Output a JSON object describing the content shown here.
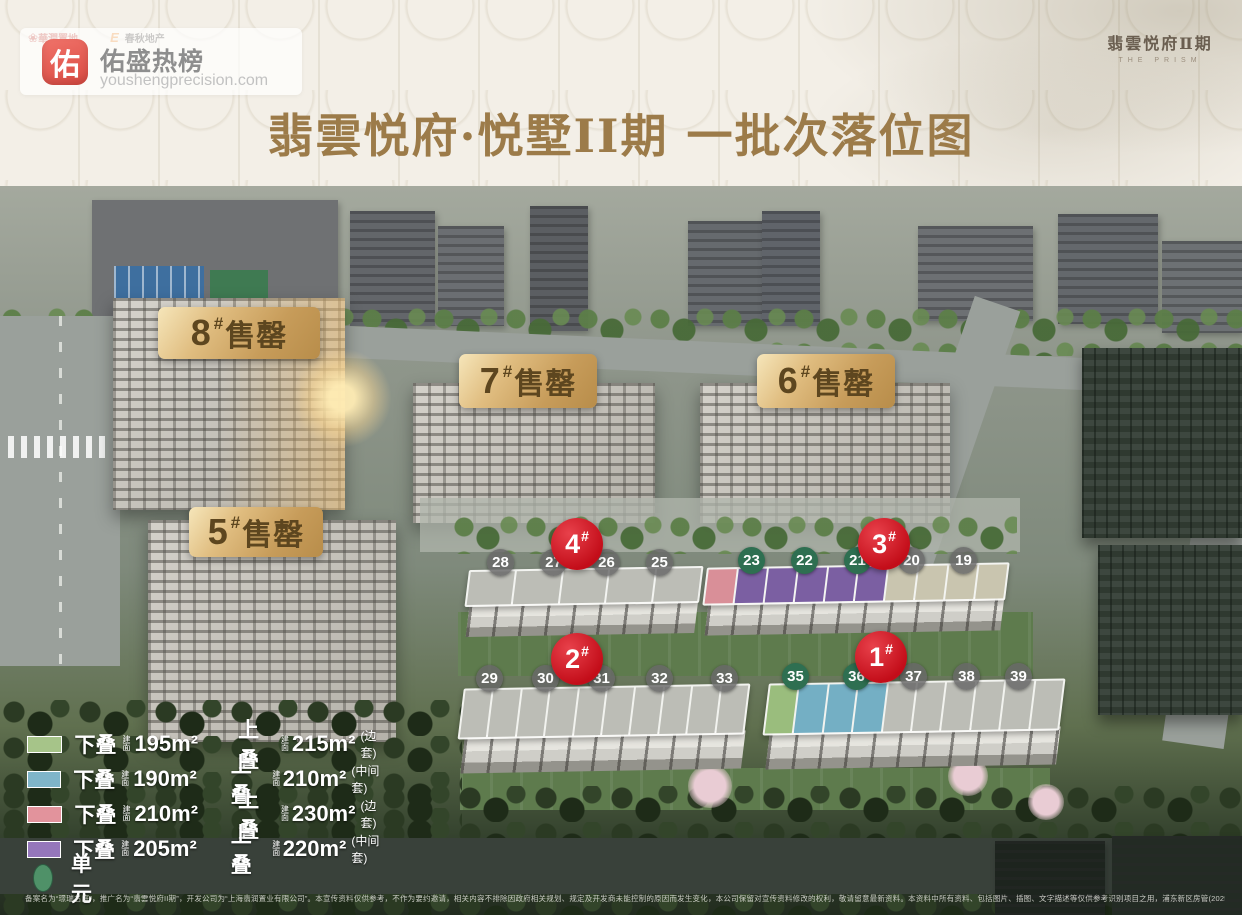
{
  "watermark": {
    "icon": "佑",
    "title": "佑盛热榜",
    "url": "youshengprecision.com"
  },
  "partners": {
    "logo_red_mark": "❀",
    "logo_red": "華潤置地",
    "logo_orange_mark": "E",
    "logo_calligraphy": "春秋地产"
  },
  "brand": {
    "name": "翡雲悦府Ⅱ期",
    "tagline": "THE PRISM"
  },
  "page_title": "翡雲悦府·悦墅II期  一批次落位图",
  "sold_out": [
    {
      "num": "8",
      "hash": "#",
      "status": "售罄"
    },
    {
      "num": "7",
      "hash": "#",
      "status": "售罄"
    },
    {
      "num": "6",
      "hash": "#",
      "status": "售罄"
    },
    {
      "num": "5",
      "hash": "#",
      "status": "售罄"
    }
  ],
  "badges": [
    {
      "num": "4",
      "hash": "#"
    },
    {
      "num": "3",
      "hash": "#"
    },
    {
      "num": "2",
      "hash": "#"
    },
    {
      "num": "1",
      "hash": "#"
    }
  ],
  "units": {
    "north": [
      {
        "num": "28",
        "chip": "chip_gray"
      },
      {
        "num": "27",
        "chip": "chip_gray"
      },
      {
        "num": "26",
        "chip": "chip_gray"
      },
      {
        "num": "25",
        "chip": "chip_gray"
      },
      {
        "num": "23",
        "chip": "chip_green"
      },
      {
        "num": "22",
        "chip": "chip_green"
      },
      {
        "num": "21",
        "chip": "chip_green"
      },
      {
        "num": "20",
        "chip": "chip_gray"
      },
      {
        "num": "19",
        "chip": "chip_gray"
      }
    ],
    "south": [
      {
        "num": "29",
        "chip": "chip_gray"
      },
      {
        "num": "30",
        "chip": "chip_gray"
      },
      {
        "num": "31",
        "chip": "chip_gray"
      },
      {
        "num": "32",
        "chip": "chip_gray"
      },
      {
        "num": "33",
        "chip": "chip_gray"
      },
      {
        "num": "35",
        "chip": "chip_green"
      },
      {
        "num": "36",
        "chip": "chip_green"
      },
      {
        "num": "37",
        "chip": "chip_gray"
      },
      {
        "num": "38",
        "chip": "chip_gray"
      },
      {
        "num": "39",
        "chip": "chip_gray"
      }
    ]
  },
  "roofs": {
    "north_left": [
      "roof_gray",
      "roof_gray",
      "roof_gray",
      "roof_gray",
      "roof_gray"
    ],
    "north_right": [
      "roof_pink",
      "roof_purple",
      "roof_purple",
      "roof_purple",
      "roof_purple",
      "roof_purple",
      "roof_beige",
      "roof_beige",
      "roof_beige",
      "roof_beige"
    ],
    "south_left": [
      "roof_gray",
      "roof_gray",
      "roof_gray",
      "roof_gray",
      "roof_gray",
      "roof_gray",
      "roof_gray",
      "roof_gray",
      "roof_gray",
      "roof_gray"
    ],
    "south_right": [
      "roof_green",
      "roof_blue",
      "roof_blue",
      "roof_blue",
      "roof_gray",
      "roof_gray",
      "roof_gray",
      "roof_gray",
      "roof_gray",
      "roof_gray"
    ]
  },
  "colors": {
    "roof_pink": "#d98f98",
    "roof_purple": "#7b5fa2",
    "roof_green": "#9abd7d",
    "roof_blue": "#74afc4",
    "roof_gray": "#bcbdb6",
    "roof_beige": "#c9c5af",
    "legend_green": "#a6c489",
    "legend_blue": "#7fb5c9",
    "legend_pink": "#e2939c",
    "legend_purple": "#9577bb",
    "chip_green": "#2e6f51",
    "chip_gray": "rgba(104,104,104,0.82)",
    "badge_red": "#c8111d",
    "label_gold": "#c79c5a",
    "label_text": "#5d461f",
    "title_gold": "#9c7b49",
    "unit_circle": "#4f9168"
  },
  "legend": {
    "area_prefix": "建面",
    "rows": [
      {
        "color": "legend_green",
        "lower_label": "下叠",
        "lower_area": "195m²",
        "upper_label": "上叠",
        "upper_area": "215m²",
        "note": "(边套)"
      },
      {
        "color": "legend_blue",
        "lower_label": "下叠",
        "lower_area": "190m²",
        "upper_label": "上叠",
        "upper_area": "210m²",
        "note": "(中间套)"
      },
      {
        "color": "legend_pink",
        "lower_label": "下叠",
        "lower_area": "210m²",
        "upper_label": "上叠",
        "upper_area": "230m²",
        "note": "(边套)"
      },
      {
        "color": "legend_purple",
        "lower_label": "下叠",
        "lower_area": "205m²",
        "upper_label": "上叠",
        "upper_area": "220m²",
        "note": "(中间套)"
      }
    ],
    "unit_label": "单元"
  },
  "disclaimer": "备案名为“璟瑞名庭”，推广名为“翡雲悦府II期”，开发公司为“上海翡润置业有限公司”。本宣传资料仅供参考，不作为要约邀请，相关内容不排除因政府相关规划、规定及开发商未能控制的原因而发生变化，本公司保留对宣传资料修改的权利，敬请留意最新资料。本资料中所有资料、包括图片、插图、文字描述等仅供参考识别项目之用，浦东新区房管(2025)预字0000157号，发布时间为2026年4月。"
}
